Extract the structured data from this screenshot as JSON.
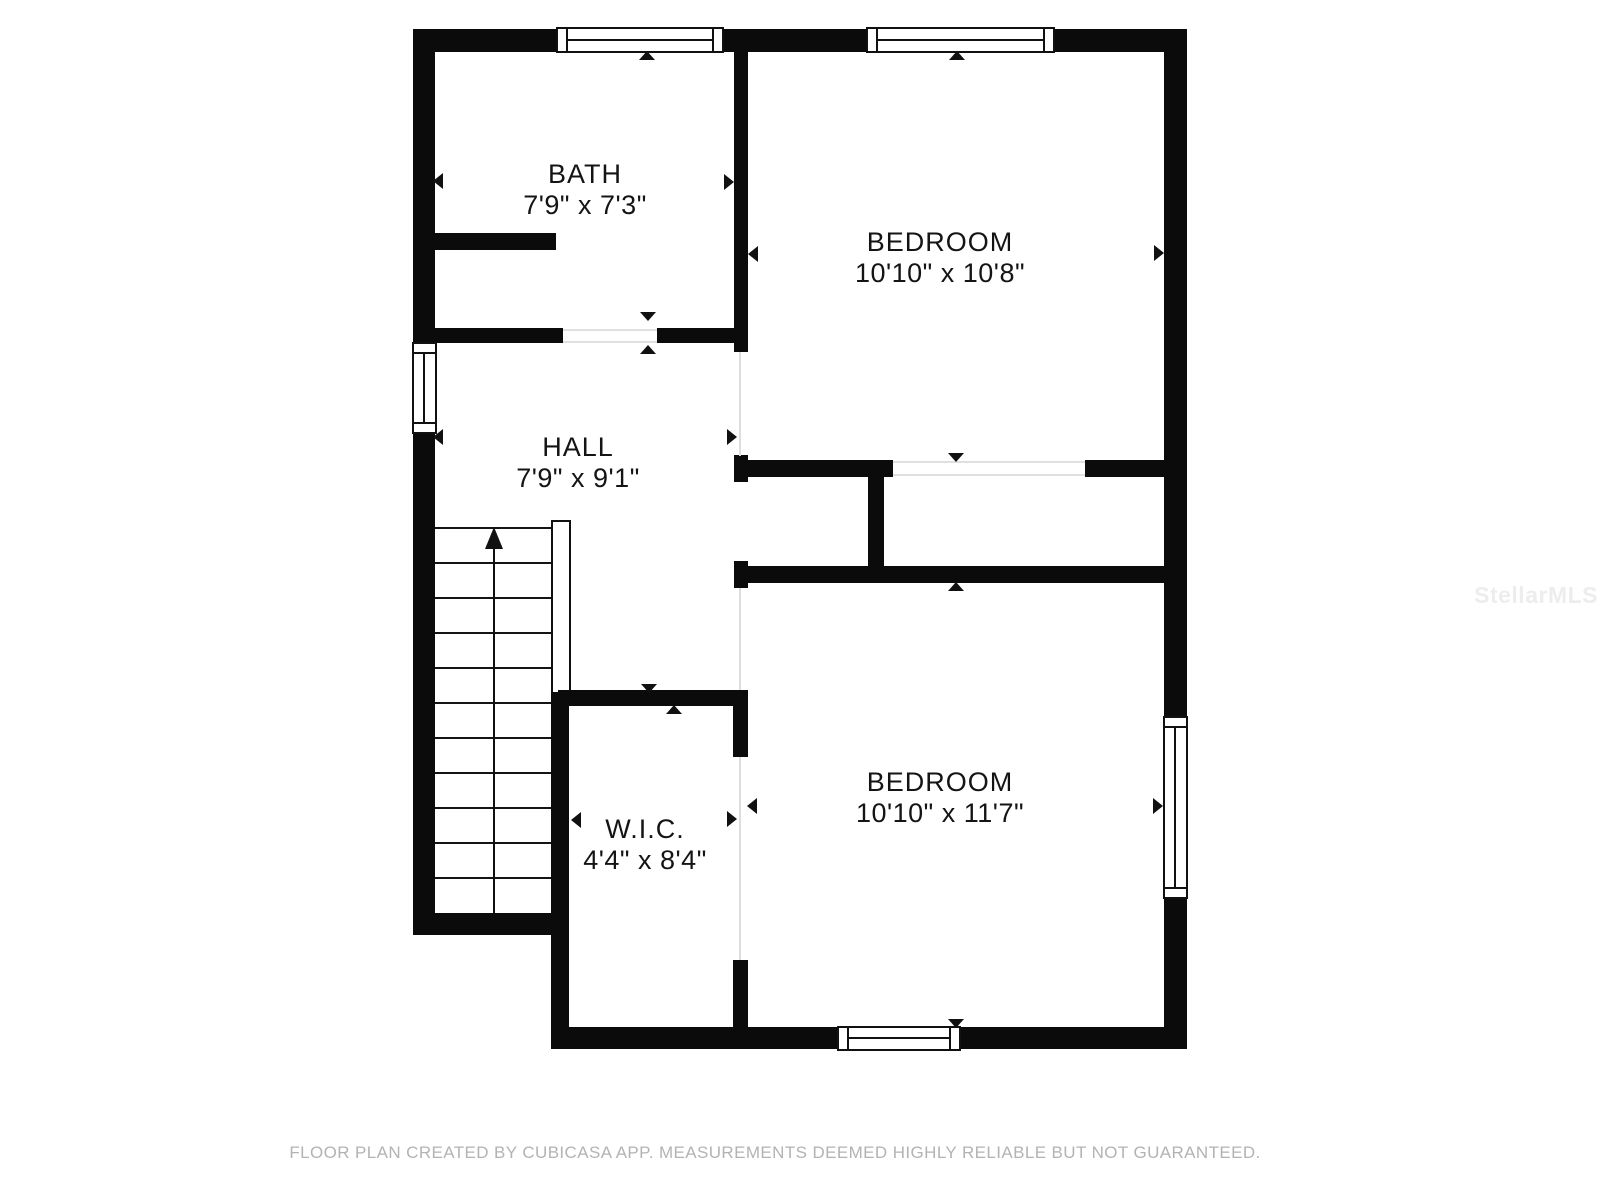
{
  "plan": {
    "rooms": [
      {
        "id": "bath",
        "name": "BATH",
        "dims": "7'9\" x 7'3\""
      },
      {
        "id": "bedroom-top",
        "name": "BEDROOM",
        "dims": "10'10\" x 10'8\""
      },
      {
        "id": "hall",
        "name": "HALL",
        "dims": "7'9\" x 9'1\""
      },
      {
        "id": "wic",
        "name": "W.I.C.",
        "dims": "4'4\" x 8'4\""
      },
      {
        "id": "bedroom-bottom",
        "name": "BEDROOM",
        "dims": "10'10\" x 11'7\""
      }
    ]
  },
  "footer": {
    "disclaimer": "FLOOR PLAN CREATED BY CUBICASA APP. MEASUREMENTS DEEMED HIGHLY RELIABLE BUT NOT GUARANTEED."
  },
  "watermark": {
    "text": "StellarMLS"
  },
  "colors": {
    "wall": "#0b0b0b",
    "background": "#ffffff",
    "footer_text": "#b3b3b3",
    "watermark_text": "#ededed"
  }
}
